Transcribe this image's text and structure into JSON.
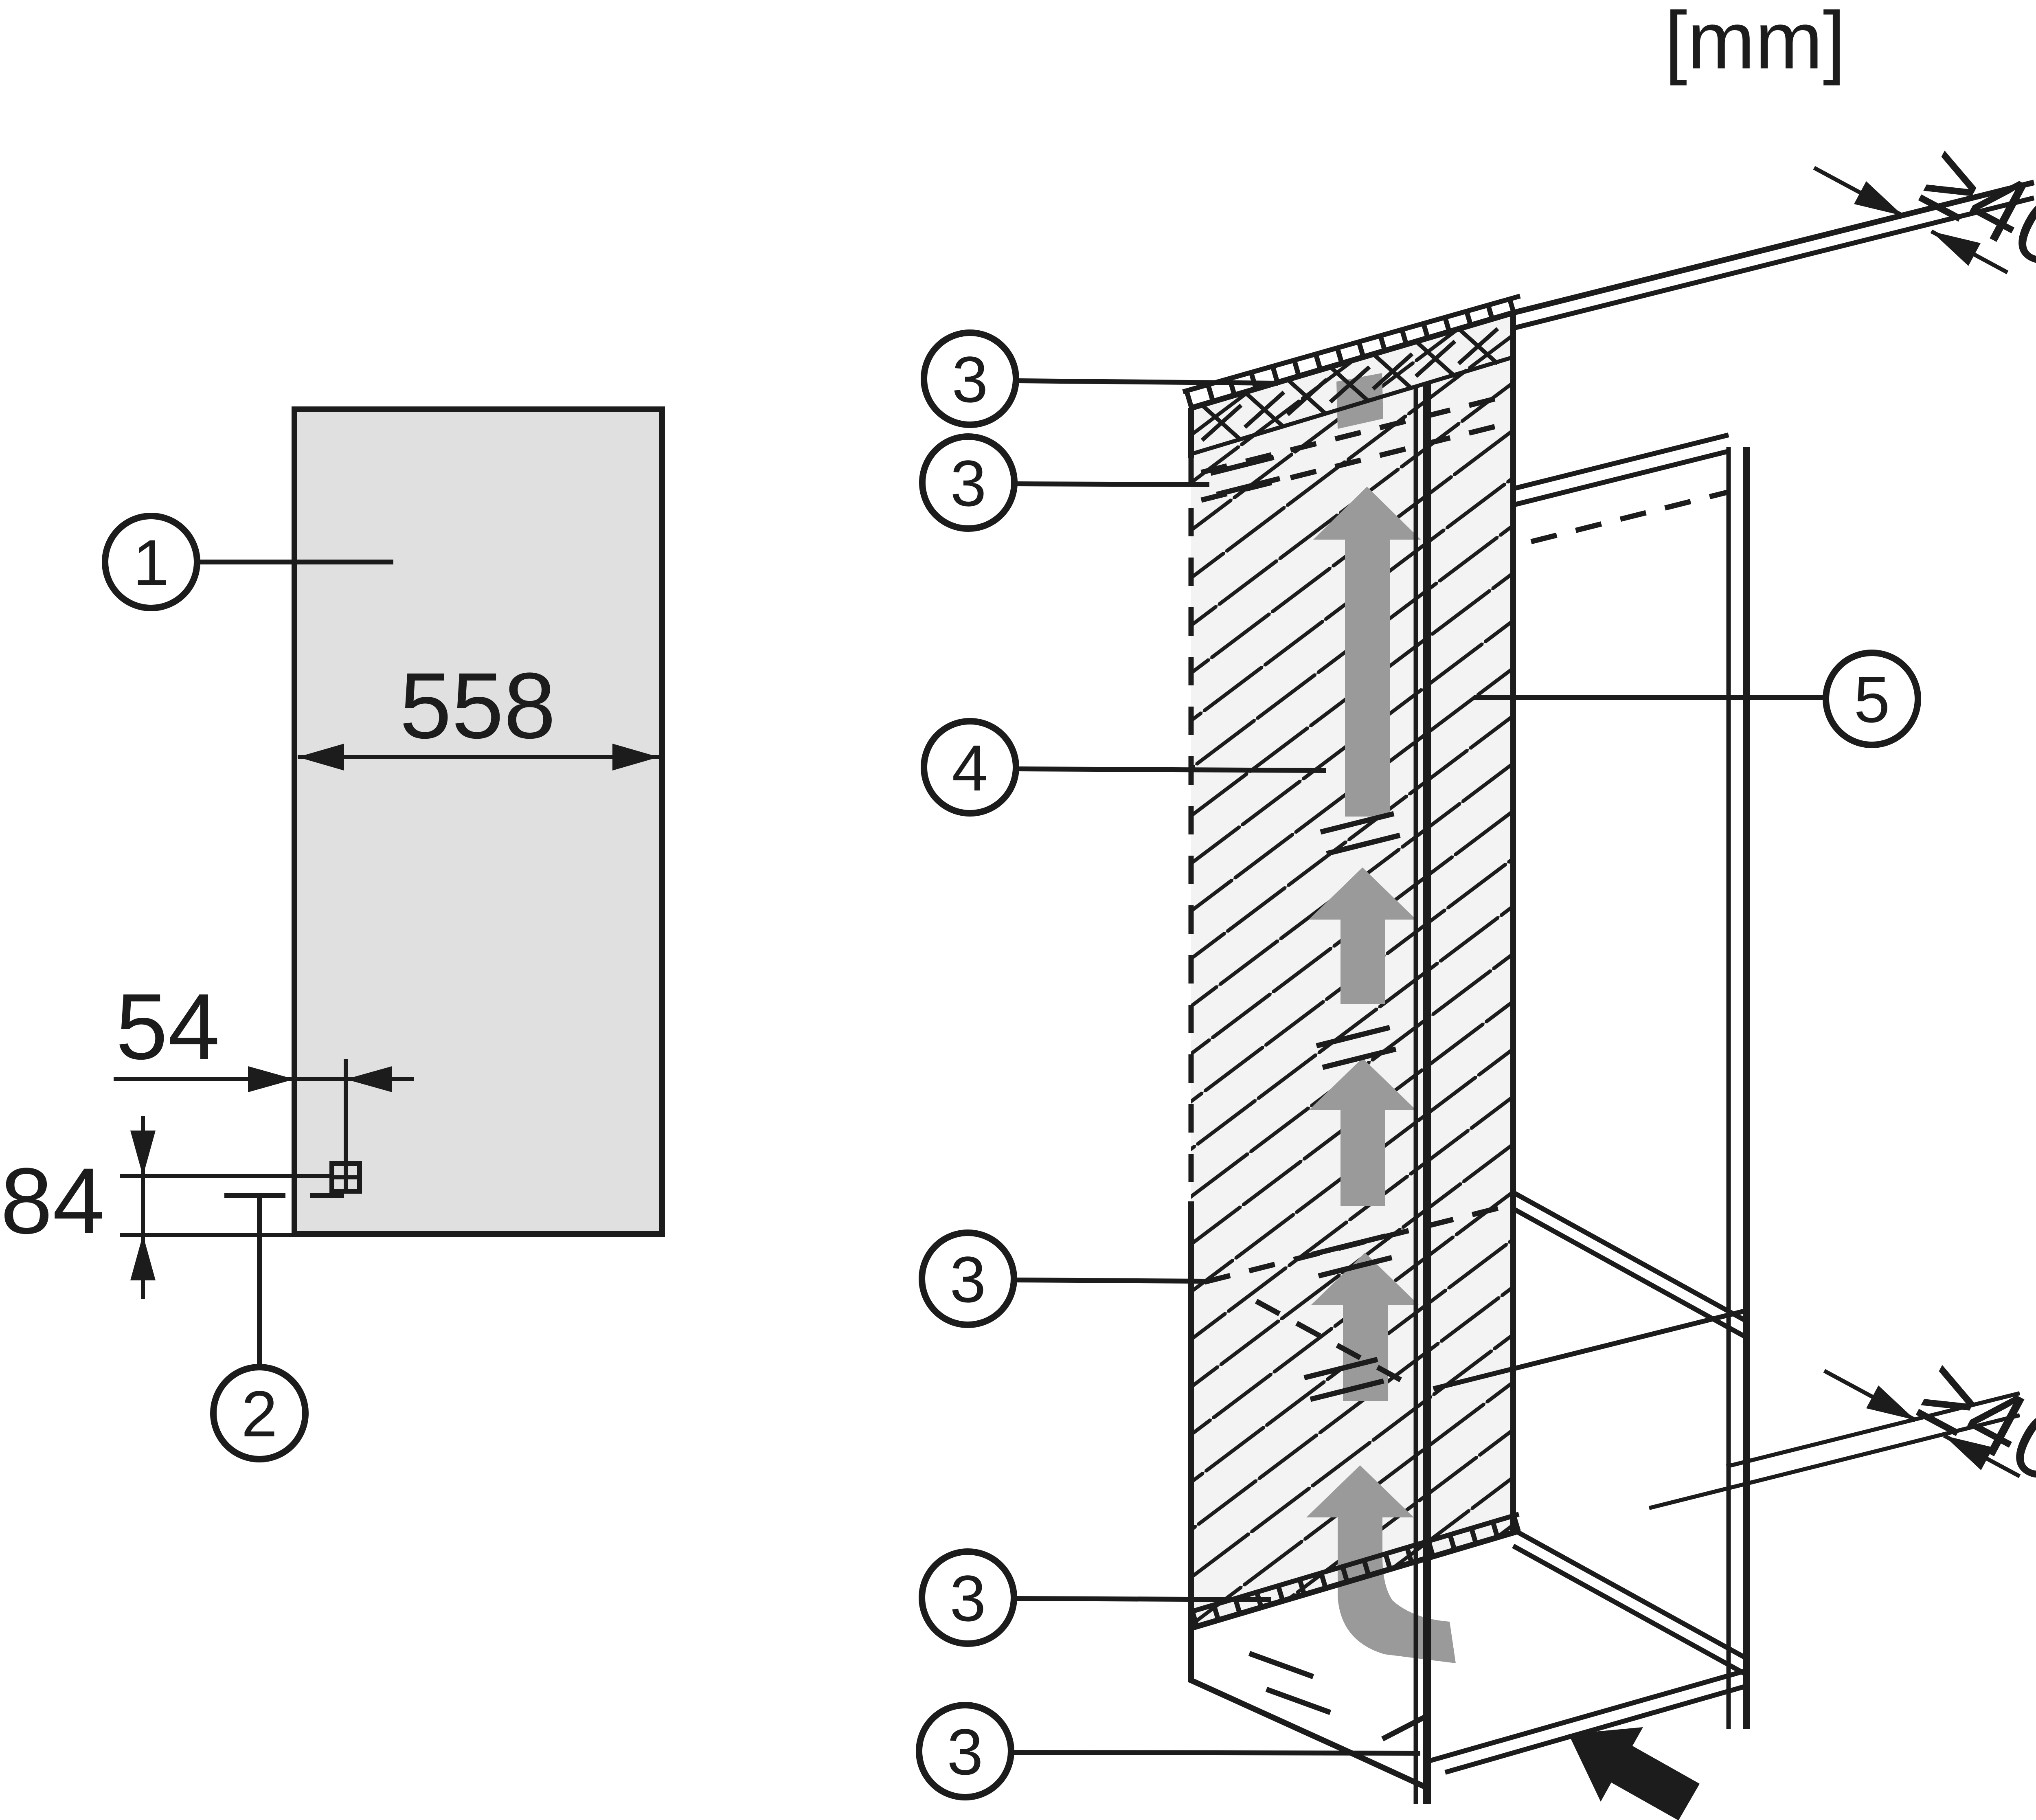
{
  "units_label": "[mm]",
  "colors": {
    "line": "#1c1c1c",
    "door_panel_fill": "#e0e0e0",
    "side_wall_fill": "#f3f3f3",
    "airflow_arrow_gray": "#9a9a9a",
    "background": "#ffffff"
  },
  "left_view": {
    "width_label": "558",
    "hinge_offset_label": "54",
    "base_height_label": "84"
  },
  "right_view": {
    "top_clearance_label": "≥40",
    "rear_clearance_label": "≥40"
  },
  "callouts": {
    "panel": "1",
    "fixing": "2",
    "vent_top_a": "3",
    "vent_top_b": "3",
    "airflow": "4",
    "back_panel": "5",
    "vent_mid": "3",
    "vent_bottom": "3",
    "plinth": "3"
  }
}
